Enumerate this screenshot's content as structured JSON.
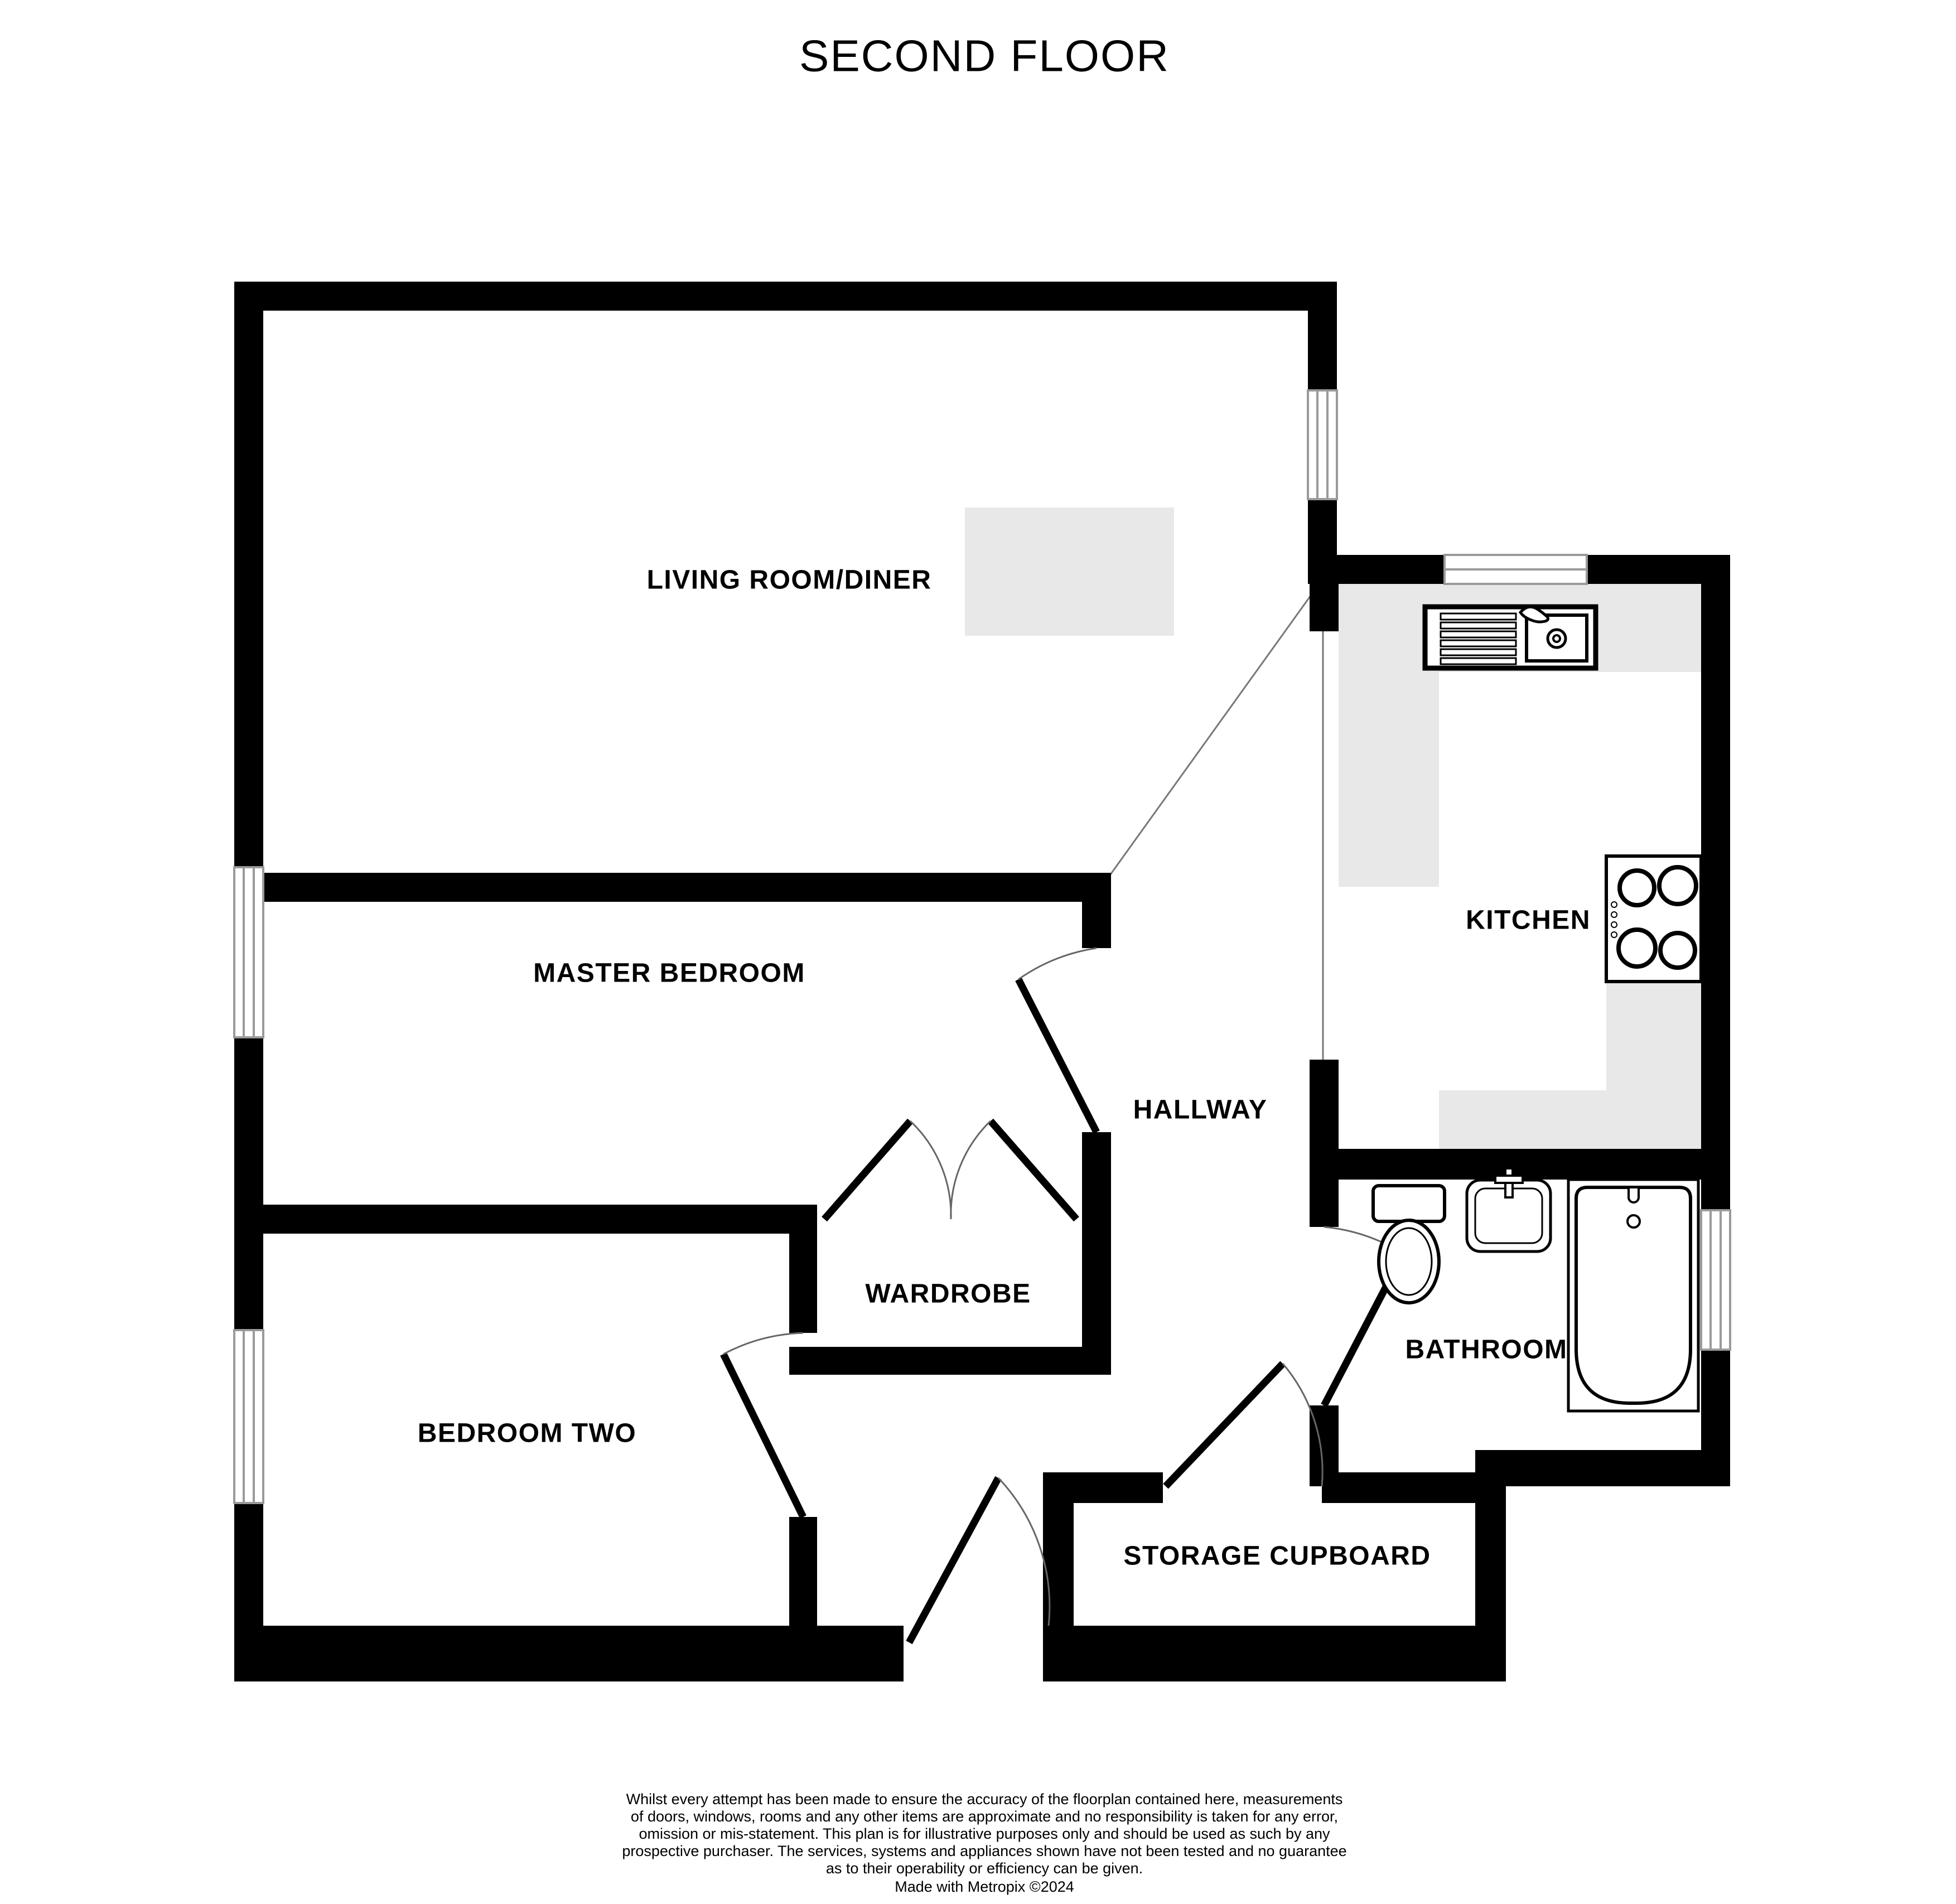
{
  "page": {
    "title": "SECOND FLOOR"
  },
  "rooms": {
    "living": {
      "label": "LIVING ROOM/DINER"
    },
    "master": {
      "label": "MASTER BEDROOM"
    },
    "bedroom2": {
      "label": "BEDROOM TWO"
    },
    "wardrobe": {
      "label": "WARDROBE"
    },
    "hallway": {
      "label": "HALLWAY"
    },
    "kitchen": {
      "label": "KITCHEN"
    },
    "bathroom": {
      "label": "BATHROOM"
    },
    "storage": {
      "label": "STORAGE CUPBOARD"
    }
  },
  "icons": {
    "kitchen_sink": "kitchen-sink-icon",
    "hob": "hob-icon",
    "toilet": "toilet-icon",
    "basin": "basin-icon",
    "bath": "bath-icon"
  },
  "colors": {
    "wall": "#000000",
    "counter": "#e8e8e8",
    "sofa": "#e8e8e8",
    "window_frame": "#9a9a9a",
    "divider_line": "#777777"
  },
  "disclaimer": {
    "lines": [
      "Whilst every attempt has been made to ensure the accuracy of the floorplan contained here, measurements",
      "of doors, windows, rooms and any other items are approximate and no responsibility is taken for any error,",
      "omission or mis-statement. This plan is for illustrative purposes only and should be used as such by any",
      "prospective purchaser. The services, systems and appliances shown have not been tested and no guarantee",
      "as to their operability or efficiency can be given."
    ],
    "credit": "Made with Metropix ©2024"
  }
}
